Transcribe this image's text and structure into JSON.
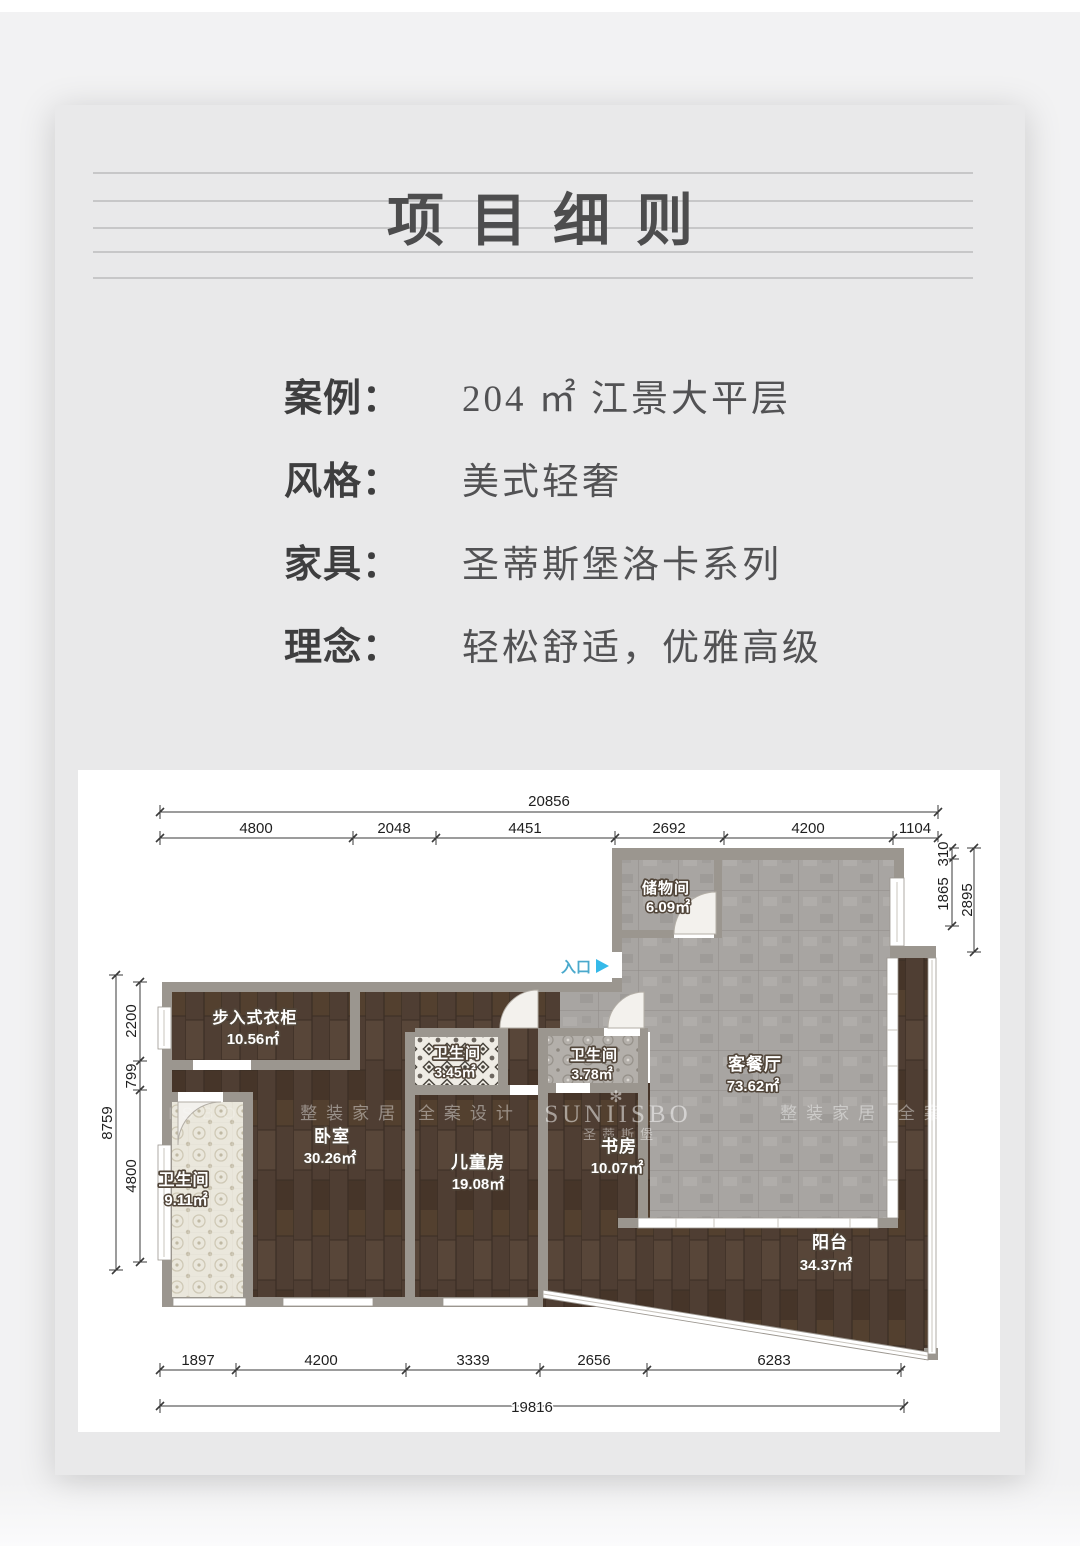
{
  "header": {
    "title": "项目细则"
  },
  "details": {
    "rows": [
      {
        "label": "案例：",
        "value": "204 ㎡ 江景大平层"
      },
      {
        "label": "风格：",
        "value": "美式轻奢"
      },
      {
        "label": "家具：",
        "value": "圣蒂斯堡洛卡系列"
      },
      {
        "label": "理念：",
        "value": "轻松舒适，优雅高级"
      }
    ]
  },
  "floorplan": {
    "entrance_label": "入口",
    "rooms": [
      {
        "name": "储物间",
        "area": "6.09㎡"
      },
      {
        "name": "客餐厅",
        "area": "73.62㎡"
      },
      {
        "name": "步入式衣柜",
        "area": "10.56㎡"
      },
      {
        "name": "卫生间",
        "area": "9.11㎡"
      },
      {
        "name": "卧室",
        "area": "30.26㎡"
      },
      {
        "name": "卫生间",
        "area": "3.45㎡"
      },
      {
        "name": "儿童房",
        "area": "19.08㎡"
      },
      {
        "name": "卫生间",
        "area": "3.78㎡"
      },
      {
        "name": "书房",
        "area": "10.07㎡"
      },
      {
        "name": "阳台",
        "area": "34.37㎡"
      }
    ],
    "dims": {
      "top": {
        "total": "20856",
        "segments": [
          "4800",
          "2048",
          "4451",
          "2692",
          "4200",
          "1104"
        ]
      },
      "bottom": {
        "total": "19816",
        "segments": [
          "1897",
          "4200",
          "3339",
          "2656",
          "6283"
        ]
      },
      "left": {
        "total": "8759",
        "segments": [
          "2200",
          "799",
          "4800"
        ]
      },
      "right": {
        "total": "2895",
        "segments": [
          "310",
          "1865"
        ]
      }
    },
    "watermarks": {
      "left": "整装家居 全案设计",
      "brand": "SUNIISBO",
      "brand_cn": "圣蒂斯堡",
      "right": "整装家居 全案设",
      "flower": "✻"
    }
  },
  "colors": {
    "accent_cyan": "#35b9e9",
    "wood": "#4f3e33",
    "tile_gray": "#a8a5a2",
    "wall": "#9b968f",
    "card_bg": "#e9e9ea"
  }
}
